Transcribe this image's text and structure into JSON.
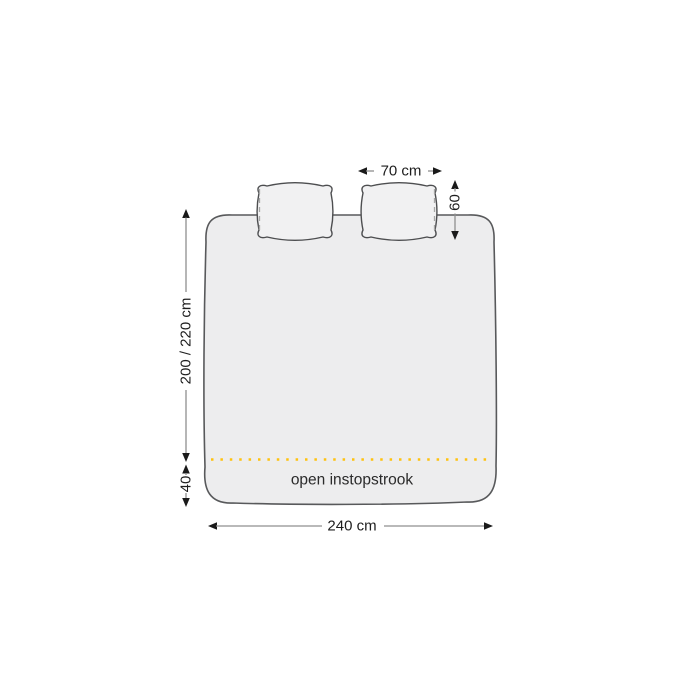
{
  "diagram": {
    "kind": "duvet-cover-dimension-diagram",
    "labels": {
      "pillow_width": "70 cm",
      "pillow_height": "60",
      "duvet_length": "200 / 220 cm",
      "tuck_strip_depth": "40",
      "duvet_width": "240 cm",
      "tuck_strip_label": "open instopstrook"
    },
    "colors": {
      "background": "#ffffff",
      "duvet_fill": "#ededee",
      "pillow_fill": "#f1f1f2",
      "outline": "#58595b",
      "dimension_line": "#8f8f8f",
      "arrow": "#1a1a1a",
      "accent_dotted_line": "#ffc20e",
      "text": "#1e1e1e"
    }
  }
}
